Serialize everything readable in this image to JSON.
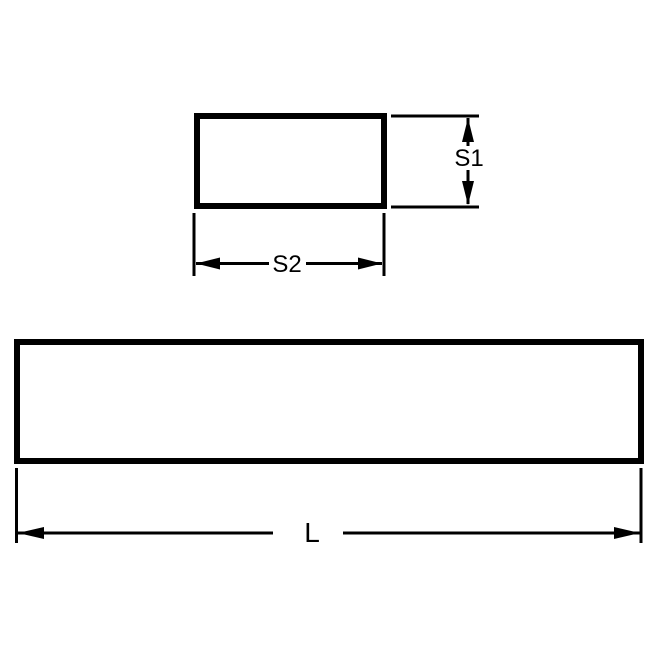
{
  "colors": {
    "background": "#ffffff",
    "line": "#000000",
    "text": "#000000"
  },
  "diagram": {
    "cross_section": {
      "height_label": "S1",
      "width_label": "S2"
    },
    "side_view": {
      "length_label": "L"
    }
  }
}
